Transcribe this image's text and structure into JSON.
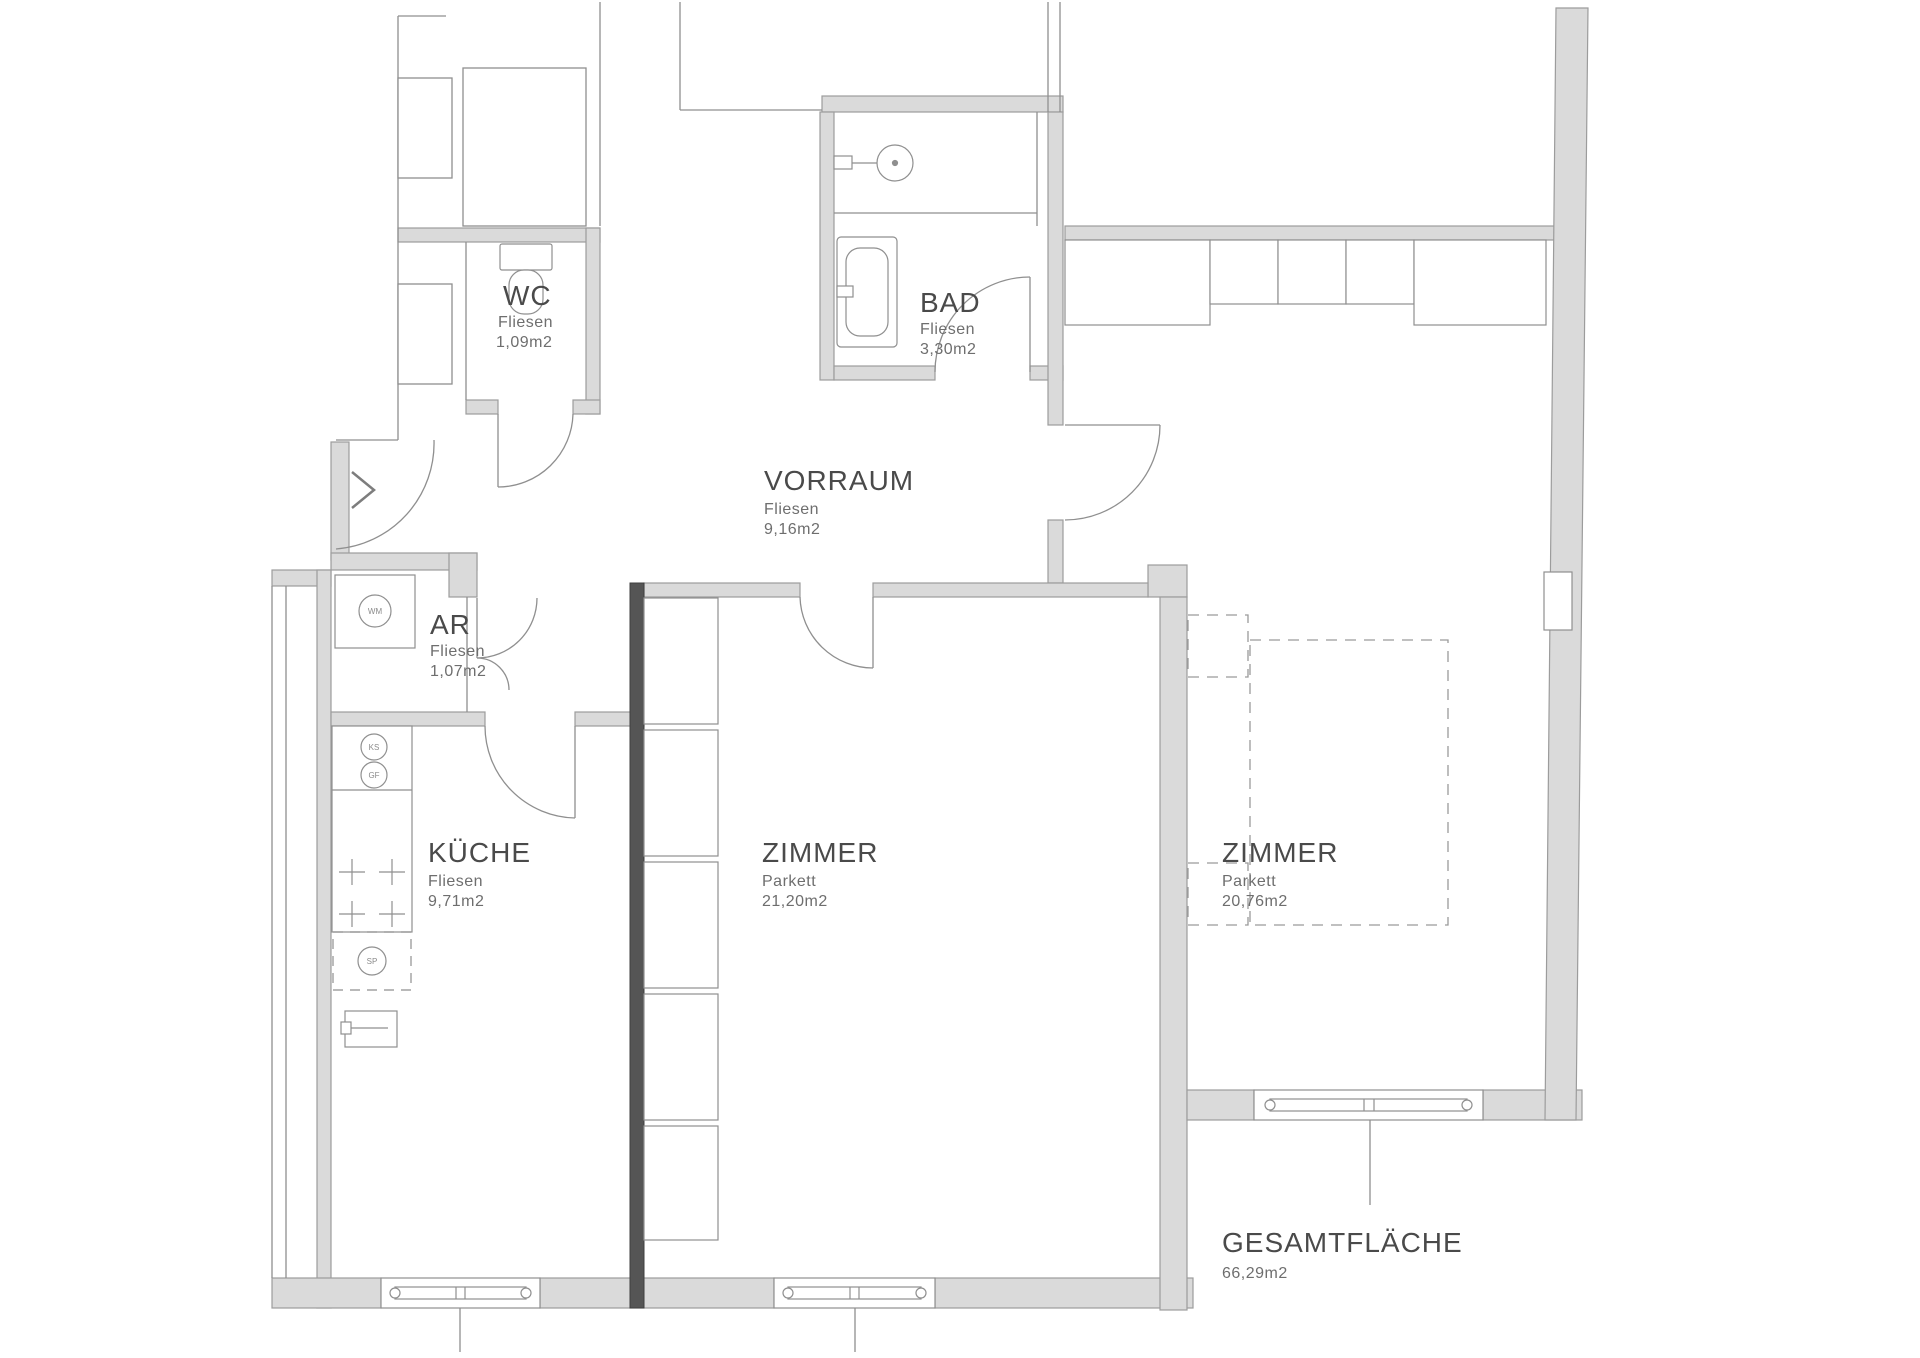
{
  "plan": {
    "rooms": [
      {
        "id": "wc",
        "name": "WC",
        "floor": "Fliesen",
        "area": "1,09m2"
      },
      {
        "id": "bad",
        "name": "BAD",
        "floor": "Fliesen",
        "area": "3,30m2"
      },
      {
        "id": "vorraum",
        "name": "VORRAUM",
        "floor": "Fliesen",
        "area": "9,16m2"
      },
      {
        "id": "ar",
        "name": "AR",
        "floor": "Fliesen",
        "area": "1,07m2"
      },
      {
        "id": "kueche",
        "name": "KÜCHE",
        "floor": "Fliesen",
        "area": "9,71m2"
      },
      {
        "id": "zimmer-mitte",
        "name": "ZIMMER",
        "floor": "Parkett",
        "area": "21,20m2"
      },
      {
        "id": "zimmer-rechts",
        "name": "ZIMMER",
        "floor": "Parkett",
        "area": "20,76m2"
      }
    ],
    "total": {
      "label": "GESAMTFLÄCHE",
      "area": "66,29m2"
    },
    "fixture_labels": {
      "washing_machine": "WM",
      "fridge": "KS",
      "freezer": "GF",
      "sink": "SP"
    },
    "colors": {
      "wall_fill": "#dadada",
      "wall_stroke": "#9c9c9c",
      "dark_wall": "#555555",
      "line": "#8f8f8f",
      "text": "#4a4a4a"
    }
  }
}
